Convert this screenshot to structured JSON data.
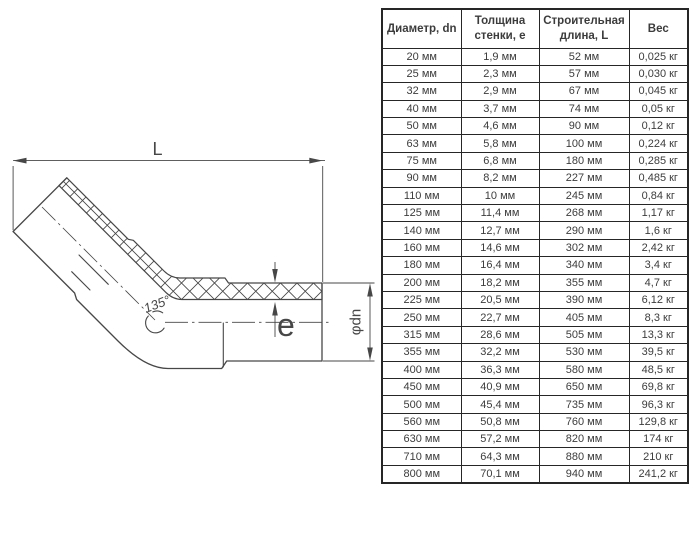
{
  "page": {
    "background": "#ffffff"
  },
  "colors": {
    "line": "#474747",
    "table_text": "#3c3c3c",
    "table_border": "#262626"
  },
  "diagram": {
    "description": "45-degree elbow pipe fitting, half-section technical drawing",
    "labels": {
      "length": "L",
      "wall_thickness": "e",
      "angle": "135°",
      "diameter": "φdn"
    }
  },
  "table": {
    "headers": [
      "Диаметр, dn",
      "Толщина стенки, e",
      "Строительная длина, L",
      "Вес"
    ],
    "rows": [
      [
        "20 мм",
        "1,9 мм",
        "52 мм",
        "0,025 кг"
      ],
      [
        "25 мм",
        "2,3 мм",
        "57 мм",
        "0,030 кг"
      ],
      [
        "32 мм",
        "2,9 мм",
        "67 мм",
        "0,045 кг"
      ],
      [
        "40 мм",
        "3,7 мм",
        "74 мм",
        "0,05 кг"
      ],
      [
        "50 мм",
        "4,6 мм",
        "90 мм",
        "0,12 кг"
      ],
      [
        "63 мм",
        "5,8 мм",
        "100 мм",
        "0,224 кг"
      ],
      [
        "75 мм",
        "6,8 мм",
        "180 мм",
        "0,285 кг"
      ],
      [
        "90 мм",
        "8,2 мм",
        "227 мм",
        "0,485 кг"
      ],
      [
        "110 мм",
        "10 мм",
        "245 мм",
        "0,84 кг"
      ],
      [
        "125 мм",
        "11,4 мм",
        "268 мм",
        "1,17 кг"
      ],
      [
        "140 мм",
        "12,7 мм",
        "290 мм",
        "1,6 кг"
      ],
      [
        "160 мм",
        "14,6 мм",
        "302 мм",
        "2,42 кг"
      ],
      [
        "180 мм",
        "16,4 мм",
        "340 мм",
        "3,4 кг"
      ],
      [
        "200 мм",
        "18,2 мм",
        "355 мм",
        "4,7 кг"
      ],
      [
        "225 мм",
        "20,5 мм",
        "390 мм",
        "6,12 кг"
      ],
      [
        "250 мм",
        "22,7 мм",
        "405 мм",
        "8,3 кг"
      ],
      [
        "315 мм",
        "28,6 мм",
        "505 мм",
        "13,3 кг"
      ],
      [
        "355 мм",
        "32,2 мм",
        "530 мм",
        "39,5 кг"
      ],
      [
        "400 мм",
        "36,3 мм",
        "580 мм",
        "48,5 кг"
      ],
      [
        "450 мм",
        "40,9 мм",
        "650 мм",
        "69,8 кг"
      ],
      [
        "500 мм",
        "45,4 мм",
        "735 мм",
        "96,3 кг"
      ],
      [
        "560 мм",
        "50,8 мм",
        "760 мм",
        "129,8 кг"
      ],
      [
        "630 мм",
        "57,2 мм",
        "820 мм",
        "174 кг"
      ],
      [
        "710 мм",
        "64,3 мм",
        "880 мм",
        "210 кг"
      ],
      [
        "800 мм",
        "70,1 мм",
        "940 мм",
        "241,2 кг"
      ]
    ]
  }
}
